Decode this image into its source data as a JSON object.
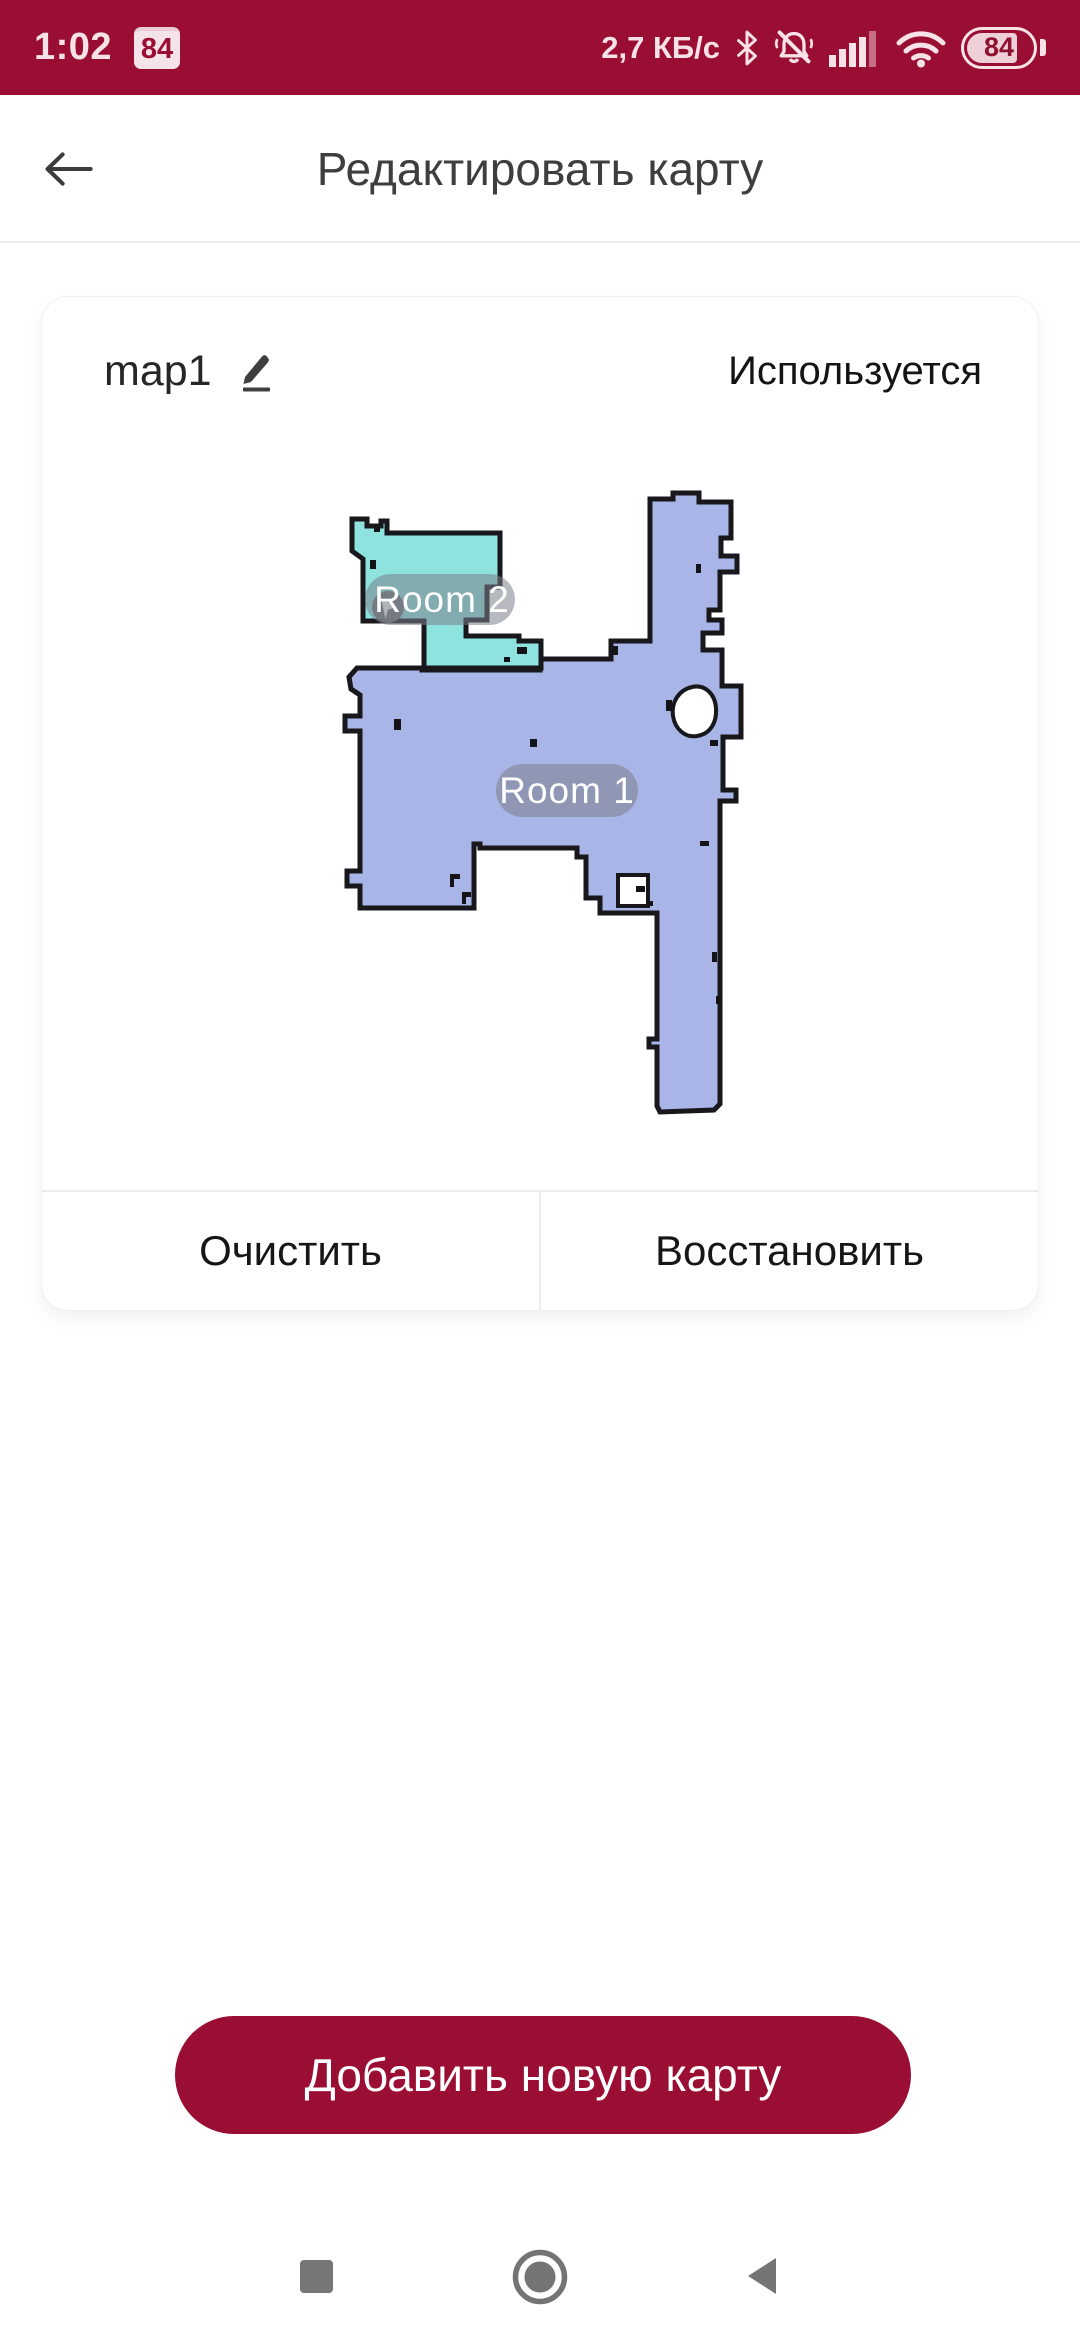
{
  "status_bar": {
    "time": "1:02",
    "notification_badge": "84",
    "network_speed": "2,7 КБ/с",
    "battery_level": "84",
    "icons": [
      "bluetooth-icon",
      "bell-muted-icon",
      "signal-icon",
      "wifi-icon",
      "battery-icon"
    ]
  },
  "header": {
    "title": "Редактировать карту"
  },
  "card": {
    "map_name": "map1",
    "status": "Используется",
    "actions": {
      "clear": "Очистить",
      "restore": "Восстановить"
    }
  },
  "map": {
    "rooms": [
      {
        "label": "Room 2",
        "color": "#8FE3DF"
      },
      {
        "label": "Room 1",
        "color": "#A9B4E7"
      }
    ],
    "outline_color": "#17171c",
    "label_pill_color": "rgba(122,128,138,0.55)",
    "marker_color": "#6F6F73"
  },
  "primary_button": {
    "label": "Добавить новую карту",
    "color": "#9B0E33"
  },
  "colors": {
    "accent_red": "#9B0E33",
    "nav_icon_gray": "#767676"
  }
}
